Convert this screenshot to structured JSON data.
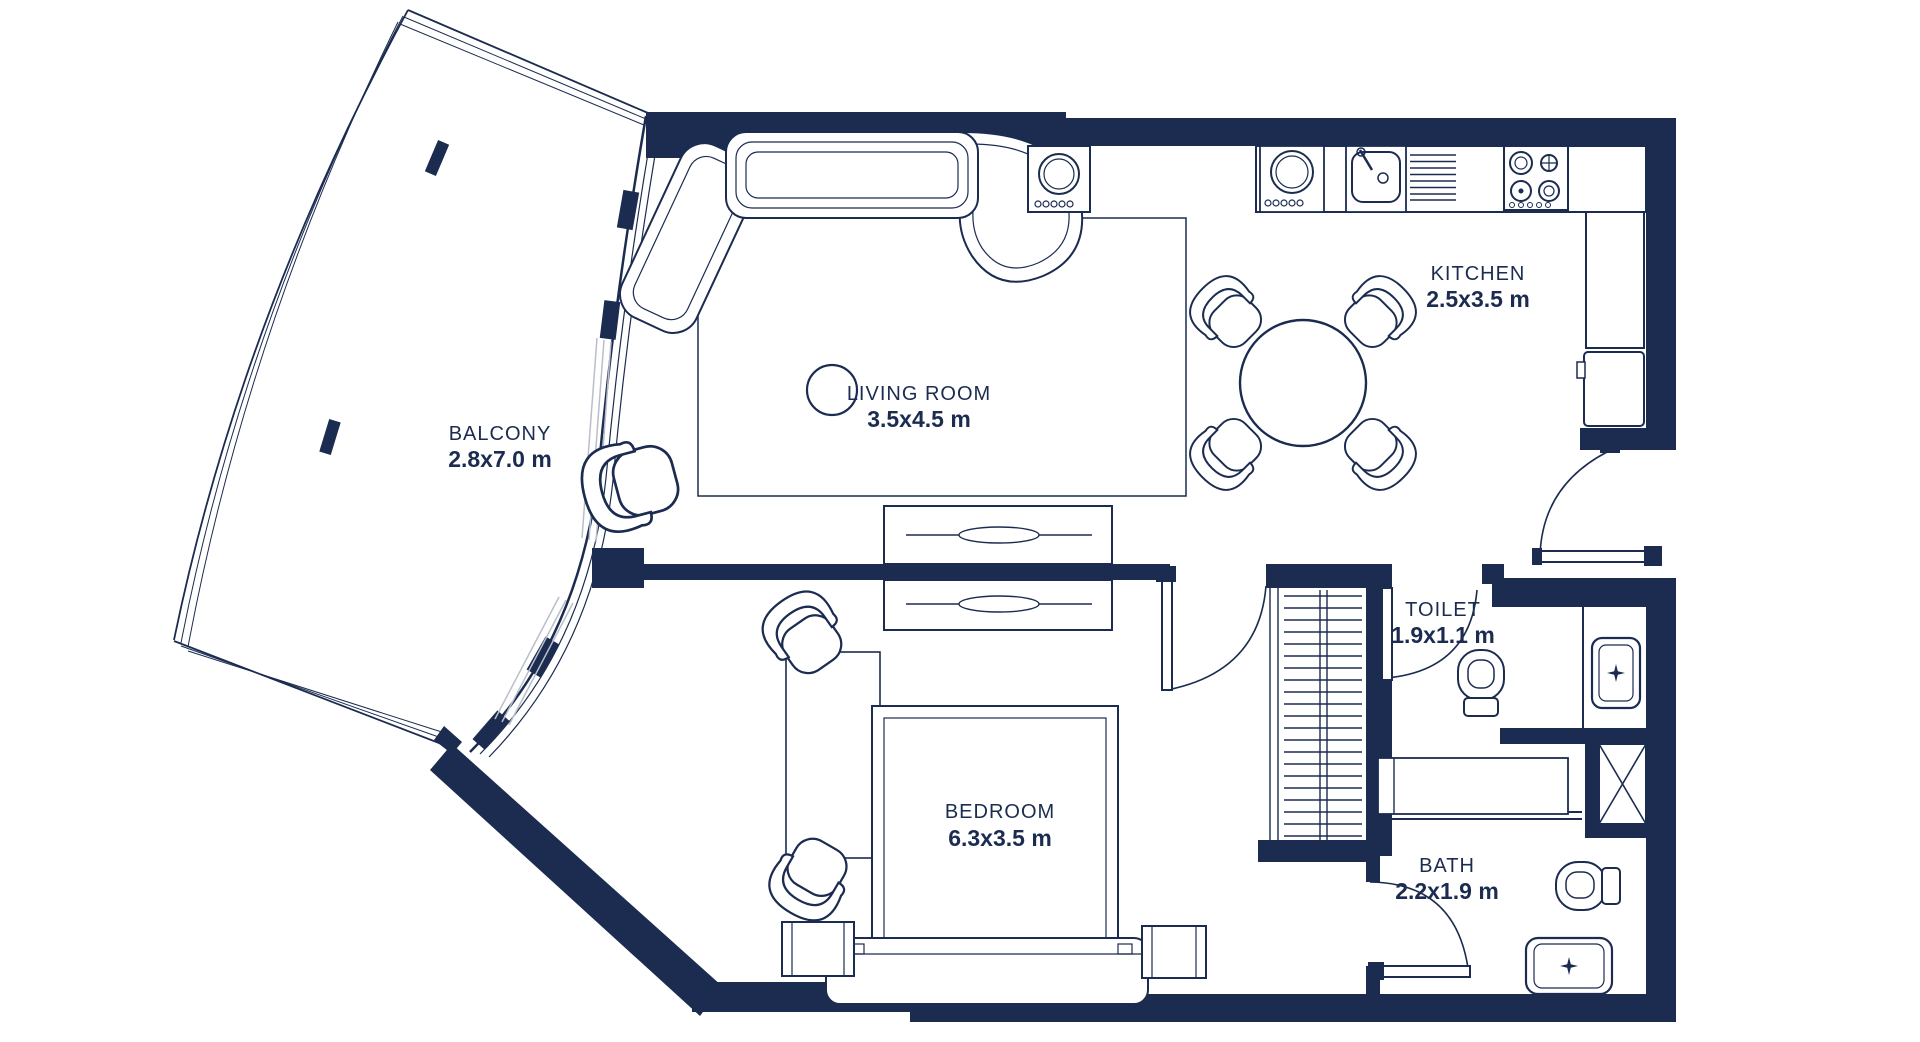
{
  "plan": {
    "type": "apartment-floor-plan",
    "colors": {
      "line": "#1b2c50",
      "glazing_gray": "#b9bfca",
      "background": "#ffffff"
    },
    "rooms": {
      "balcony": {
        "name": "BALCONY",
        "dims": "2.8x7.0 m"
      },
      "living": {
        "name": "LIVING ROOM",
        "dims": "3.5x4.5 m"
      },
      "kitchen": {
        "name": "KITCHEN",
        "dims": "2.5x3.5 m"
      },
      "toilet": {
        "name": "TOILET",
        "dims": "1.9x1.1 m"
      },
      "bedroom": {
        "name": "BEDROOM",
        "dims": "6.3x3.5 m"
      },
      "bath": {
        "name": "BATH",
        "dims": "2.2x1.9 m"
      }
    }
  }
}
